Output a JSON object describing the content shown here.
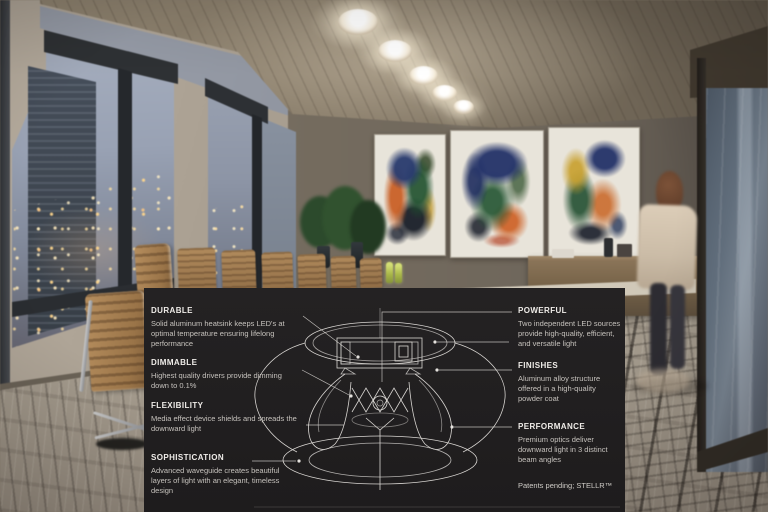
{
  "overlay": {
    "features_left": [
      {
        "title": "DURABLE",
        "body": "Solid aluminum heatsink keeps LED's at optimal temperature ensuring lifelong performance"
      },
      {
        "title": "DIMMABLE",
        "body": "Highest quality drivers provide dimming down to 0.1%"
      },
      {
        "title": "FLEXIBILITY",
        "body": "Media effect device shields and spreads the downward light"
      },
      {
        "title": "SOPHISTICATION",
        "body": "Advanced waveguide creates beautiful layers of light with an elegant, timeless design"
      }
    ],
    "features_right": [
      {
        "title": "POWERFUL",
        "body": "Two independent LED sources provide high-quality, efficient, and versatile light"
      },
      {
        "title": "FINISHES",
        "body": "Aluminum alloy structure offered in a high-quality powder coat"
      },
      {
        "title": "PERFORMANCE",
        "body": "Premium optics deliver downward light in 3 distinct beam angles"
      }
    ],
    "footer": "Patents pending; STELLR™",
    "colors": {
      "panel_bg": "#1f1d1e",
      "heading_text": "#efece8",
      "body_text": "#c6c2bd",
      "callout_line": "#cfccc8",
      "diagram_stroke": "#e9e6e2",
      "ceiling_glow": "#fff3db",
      "chair_tan": "#a8835a",
      "bottle_green": "#b6c24f"
    }
  }
}
